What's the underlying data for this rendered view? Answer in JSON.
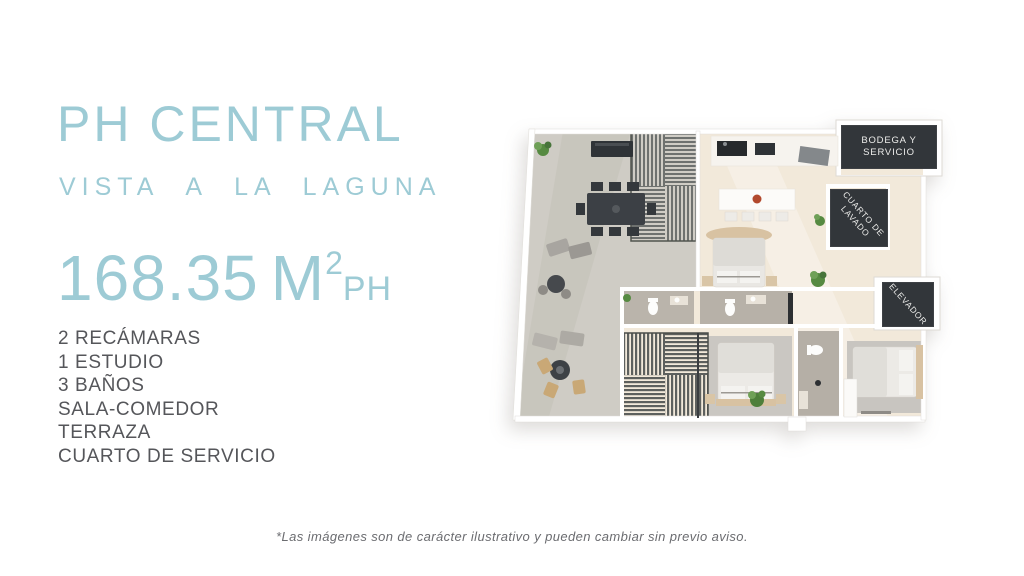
{
  "page": {
    "background": "#ffffff"
  },
  "left_panel": {
    "title": "PH CENTRAL",
    "subtitle": "Vista a la Laguna",
    "area": {
      "value": "168.35",
      "unit": "M",
      "superscript": "2",
      "suffix": "PH"
    },
    "features": [
      "2 RECÁMARAS",
      "1 ESTUDIO",
      "3 BAÑOS",
      "SALA-COMEDOR",
      "TERRAZA",
      "CUARTO DE SERVICIO"
    ],
    "accent_color": "#9DCBD5",
    "text_color": "#55565A"
  },
  "floorplan": {
    "labels": {
      "bodega_line1": "BODEGA Y",
      "bodega_line2": "SERVICIO",
      "lavado_line1": "CUARTO DE",
      "lavado_line2": "LAVADO",
      "elevador": "ELEVADOR"
    },
    "colors": {
      "interior_floor": "#F2E9DA",
      "terrace_floor": "#CFCCC5",
      "bathroom_floor": "#B7B1A8",
      "dark_panel": "#32363A",
      "dark_furniture": "#3C4045",
      "wood_tan": "#D8C2A2",
      "plant_green": "#568A41"
    }
  },
  "footer": {
    "disclaimer": "*Las imágenes son de carácter ilustrativo y pueden cambiar sin previo aviso."
  }
}
